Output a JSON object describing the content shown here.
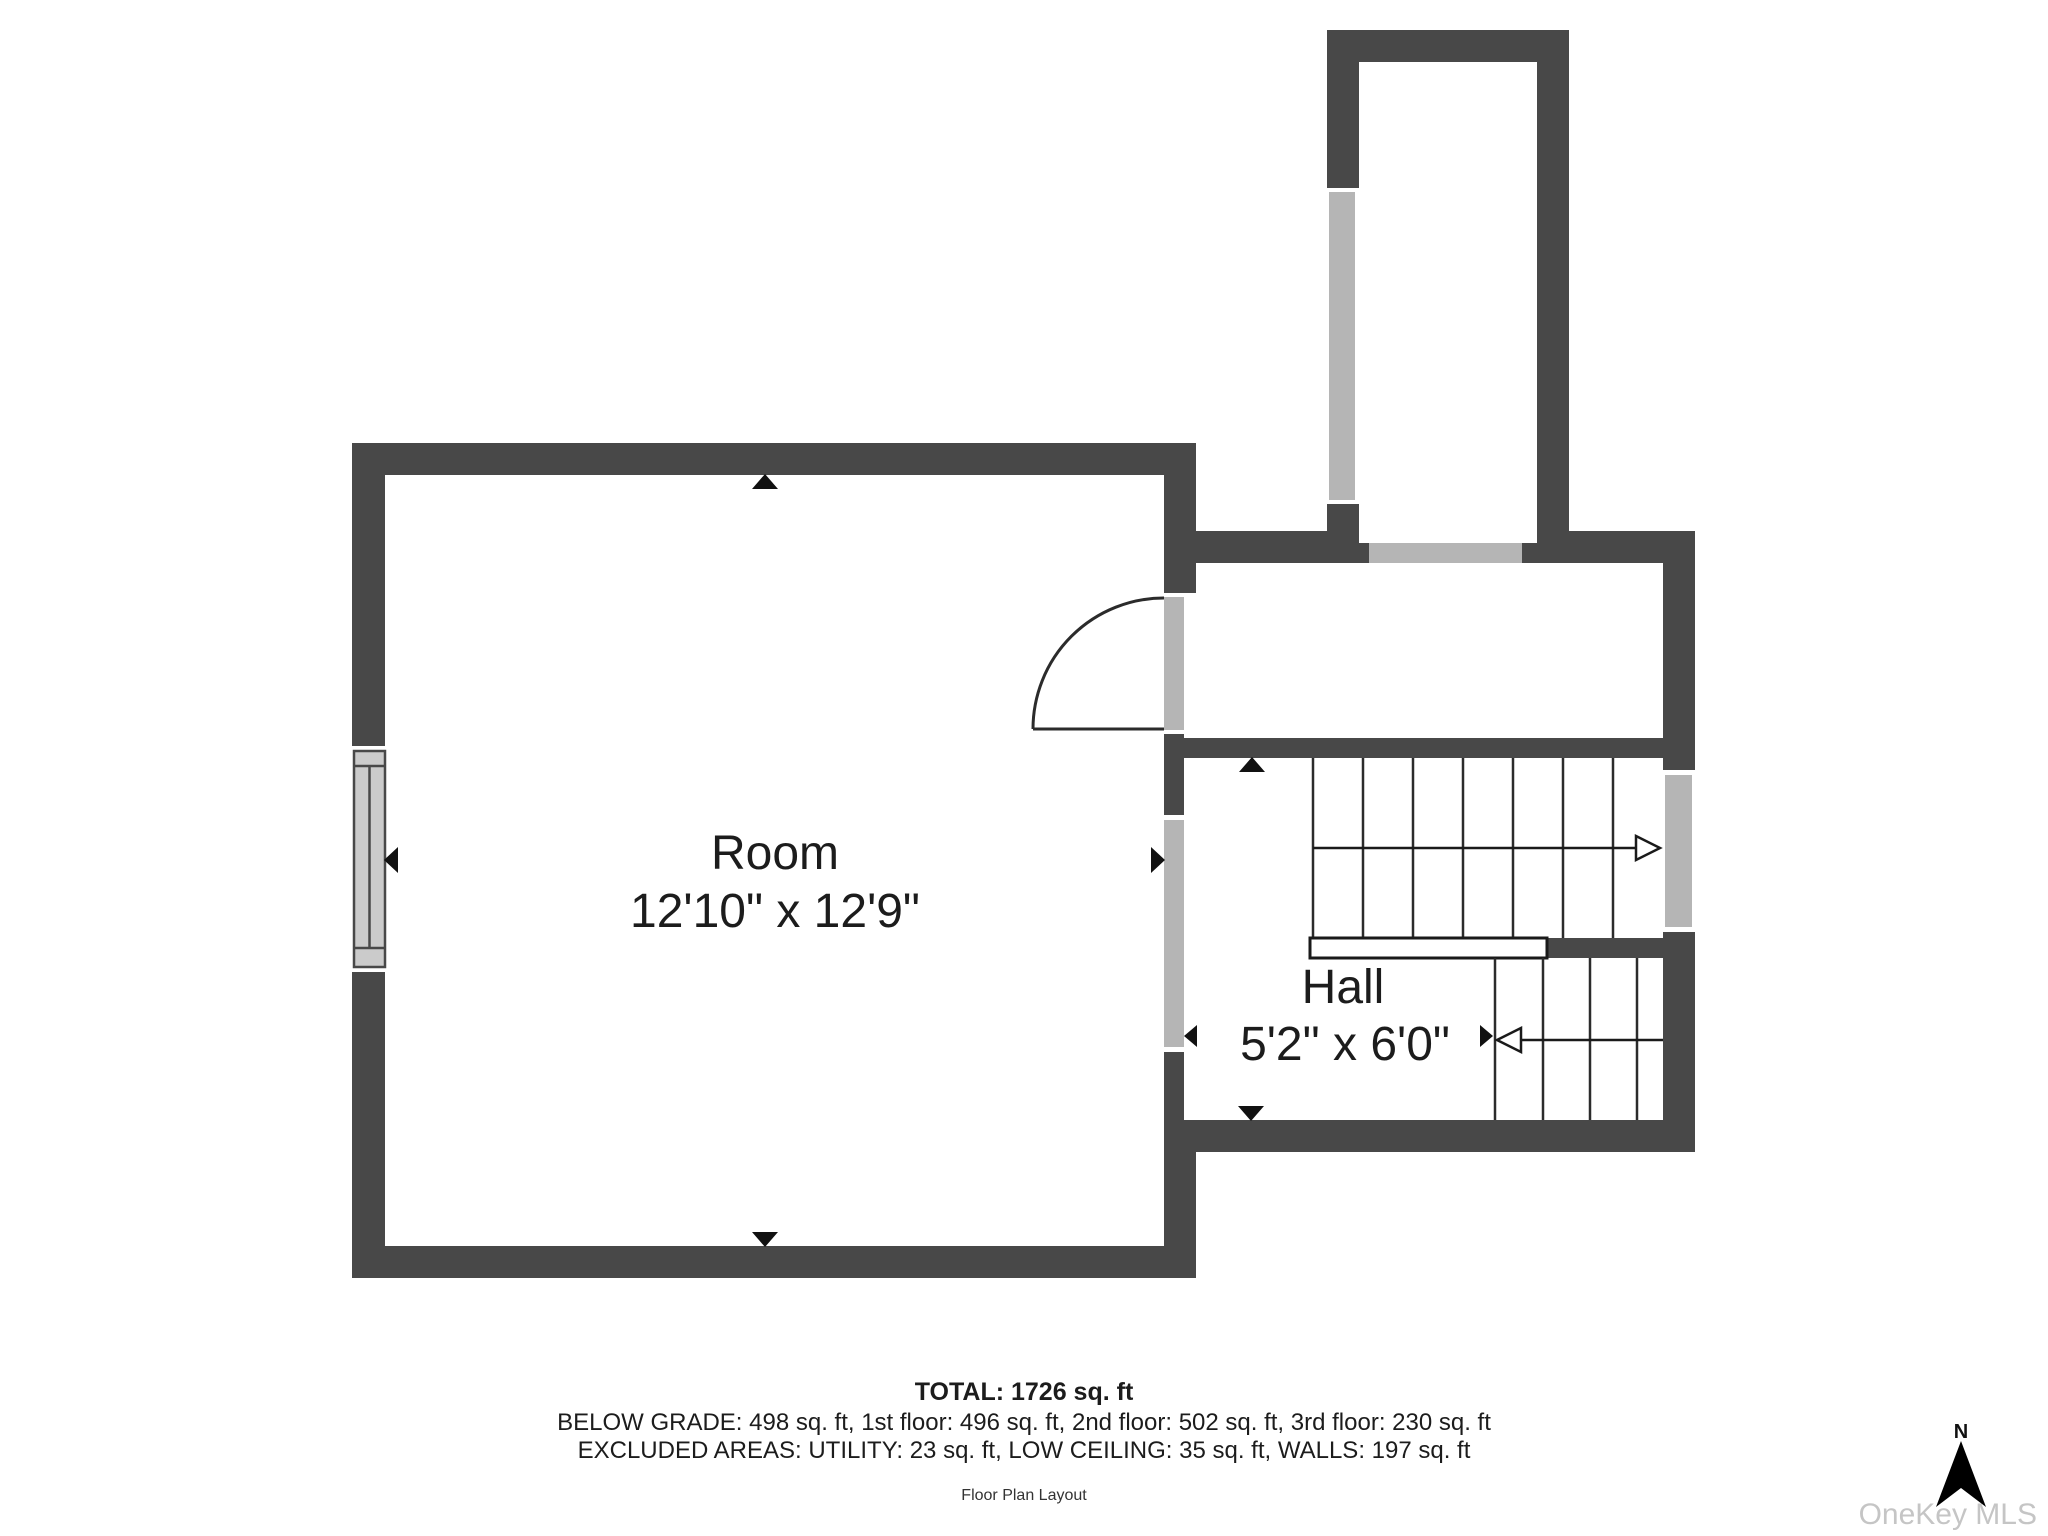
{
  "rooms": [
    {
      "id": "room",
      "label": "Room",
      "dimensions": "12'10\" x 12'9\""
    },
    {
      "id": "hall",
      "label": "Hall",
      "dimensions": "5'2\" x 6'0\""
    }
  ],
  "summary": {
    "total": "TOTAL: 1726 sq. ft",
    "floors": "BELOW GRADE: 498 sq. ft, 1st floor: 496 sq. ft, 2nd floor: 502 sq. ft, 3rd floor: 230 sq. ft",
    "excluded": "EXCLUDED AREAS: UTILITY: 23 sq. ft, LOW CEILING: 35 sq. ft, WALLS: 197 sq. ft",
    "caption": "Floor Plan Layout"
  },
  "compass": {
    "label": "N"
  },
  "watermark": {
    "text": "OneKey MLS"
  },
  "colors": {
    "wall": "#484848",
    "window": "#b5b5b5",
    "window_pane": "#cbcbcb",
    "stair_line": "#2b2b2b",
    "text": "#1c1c1c",
    "watermark": "#c5c5c5",
    "background": "#ffffff"
  }
}
